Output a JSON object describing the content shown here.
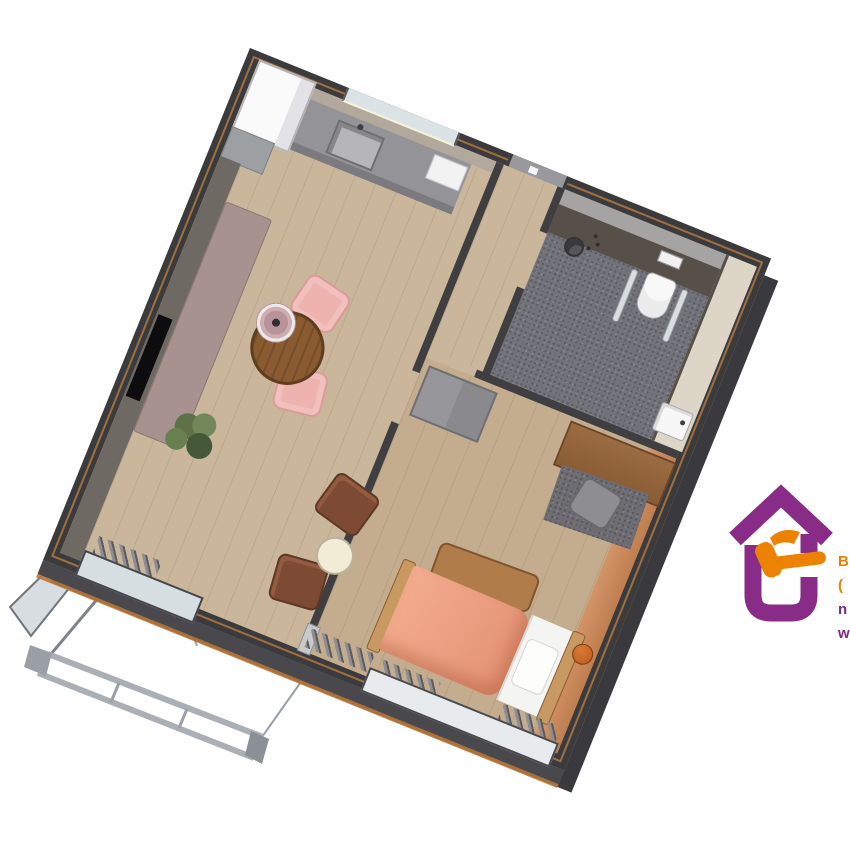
{
  "scene": {
    "description": "3D isometric render of a small one-bedroom apartment floor plan, rotated, on a white background",
    "background": "#ffffff",
    "plan_rotation_deg": 22
  },
  "plan": {
    "walls": {
      "exterior_color": "#3b3b3d",
      "interior_color": "#3f3f41",
      "trim_color": "#c08242",
      "left_wall_face_color": "#6f6963",
      "kitchen_wall_face_color": "#b2a99c"
    },
    "rooms": {
      "living_kitchen": {
        "name": "living room with kitchen",
        "floor_color": "#c9b69b"
      },
      "hall": {
        "name": "entrance hall",
        "floor_color": "#c9b69b"
      },
      "bathroom": {
        "name": "bathroom",
        "floor_color": "#72727a",
        "wall_dark": "#575049",
        "wall_light": "#a5a4a2",
        "wall_beige": "#ddd5c6"
      },
      "bedroom": {
        "name": "bedroom",
        "floor_color": "#c4ad8e",
        "accent_wall_color": "#cf8f63"
      }
    },
    "openings": {
      "front_door": {
        "name": "front door",
        "color": "#97999d"
      },
      "balcony_door": {
        "name": "balcony sliding door",
        "color": "#d7dee2"
      },
      "kitchen_window": {
        "name": "kitchen window",
        "color": "#dce3e7"
      },
      "bedroom_window": {
        "name": "bedroom window",
        "color": "#e7ebee"
      }
    },
    "furniture": {
      "fridge": {
        "name": "tall white kitchen unit",
        "color": "#fafafa"
      },
      "counter": {
        "name": "kitchen counter with sink",
        "color": "#949498"
      },
      "cooktop": {
        "name": "cooktop",
        "color": "#f2f2f2"
      },
      "dining_table": {
        "name": "round wooden dining table",
        "color": "#8a5a30"
      },
      "pendant_lamp": {
        "name": "pendant lamp",
        "color": "#b8939a"
      },
      "dining_chairs": {
        "count": 2,
        "color": "#eeb3af"
      },
      "bench_sofa": {
        "name": "long bench sofa",
        "color": "#a7928f"
      },
      "tv": {
        "name": "wall TV",
        "color": "#0d0d0f"
      },
      "plant": {
        "name": "potted plant",
        "color": "#5d7247"
      },
      "lounge_chairs": {
        "count": 2,
        "color": "#7d4b33"
      },
      "side_table": {
        "name": "round side table",
        "color": "#f2ecd6"
      },
      "shower": {
        "name": "shower head",
        "color": "#55555a"
      },
      "toilet": {
        "name": "wall hung toilet",
        "color": "#f8f8f8"
      },
      "grab_bars": {
        "count": 2,
        "color": "#d9dde0"
      },
      "bath_sink": {
        "name": "washbasin",
        "color": "#f7f7f7"
      },
      "wardrobe": {
        "name": "wardrobe",
        "color": "#97979b"
      },
      "desk": {
        "name": "wooden desk",
        "color": "#8f6239"
      },
      "desk_chair": {
        "name": "desk chair",
        "color": "#8e8e92"
      },
      "rug": {
        "name": "gray rug",
        "color": "#6d6d73"
      },
      "bed": {
        "name": "single bed",
        "duvet_color": "#eda184",
        "linen_color": "#f4f4f2",
        "frame_color": "#c89a62"
      },
      "overbed_table": {
        "name": "overbed table",
        "color": "#b07c4a"
      },
      "basketball": {
        "name": "basketball",
        "color": "#c4661f"
      },
      "radiators": {
        "count": 3,
        "color": "#8e8e92"
      }
    },
    "exterior": {
      "railing_color": "#a9afb5",
      "glass_panel_color": "#b2bcc4",
      "terrace_trim_color": "#b9773a"
    }
  },
  "logo": {
    "house_color": "#882c88",
    "hammer_color": "#ec8200",
    "text_fragments": [
      {
        "text": "B",
        "color": "#ec8200"
      },
      {
        "text": "(",
        "color": "#ec8200"
      },
      {
        "text": "n",
        "color": "#7c2a7f"
      },
      {
        "text": "w",
        "color": "#7c2a7f"
      }
    ]
  }
}
